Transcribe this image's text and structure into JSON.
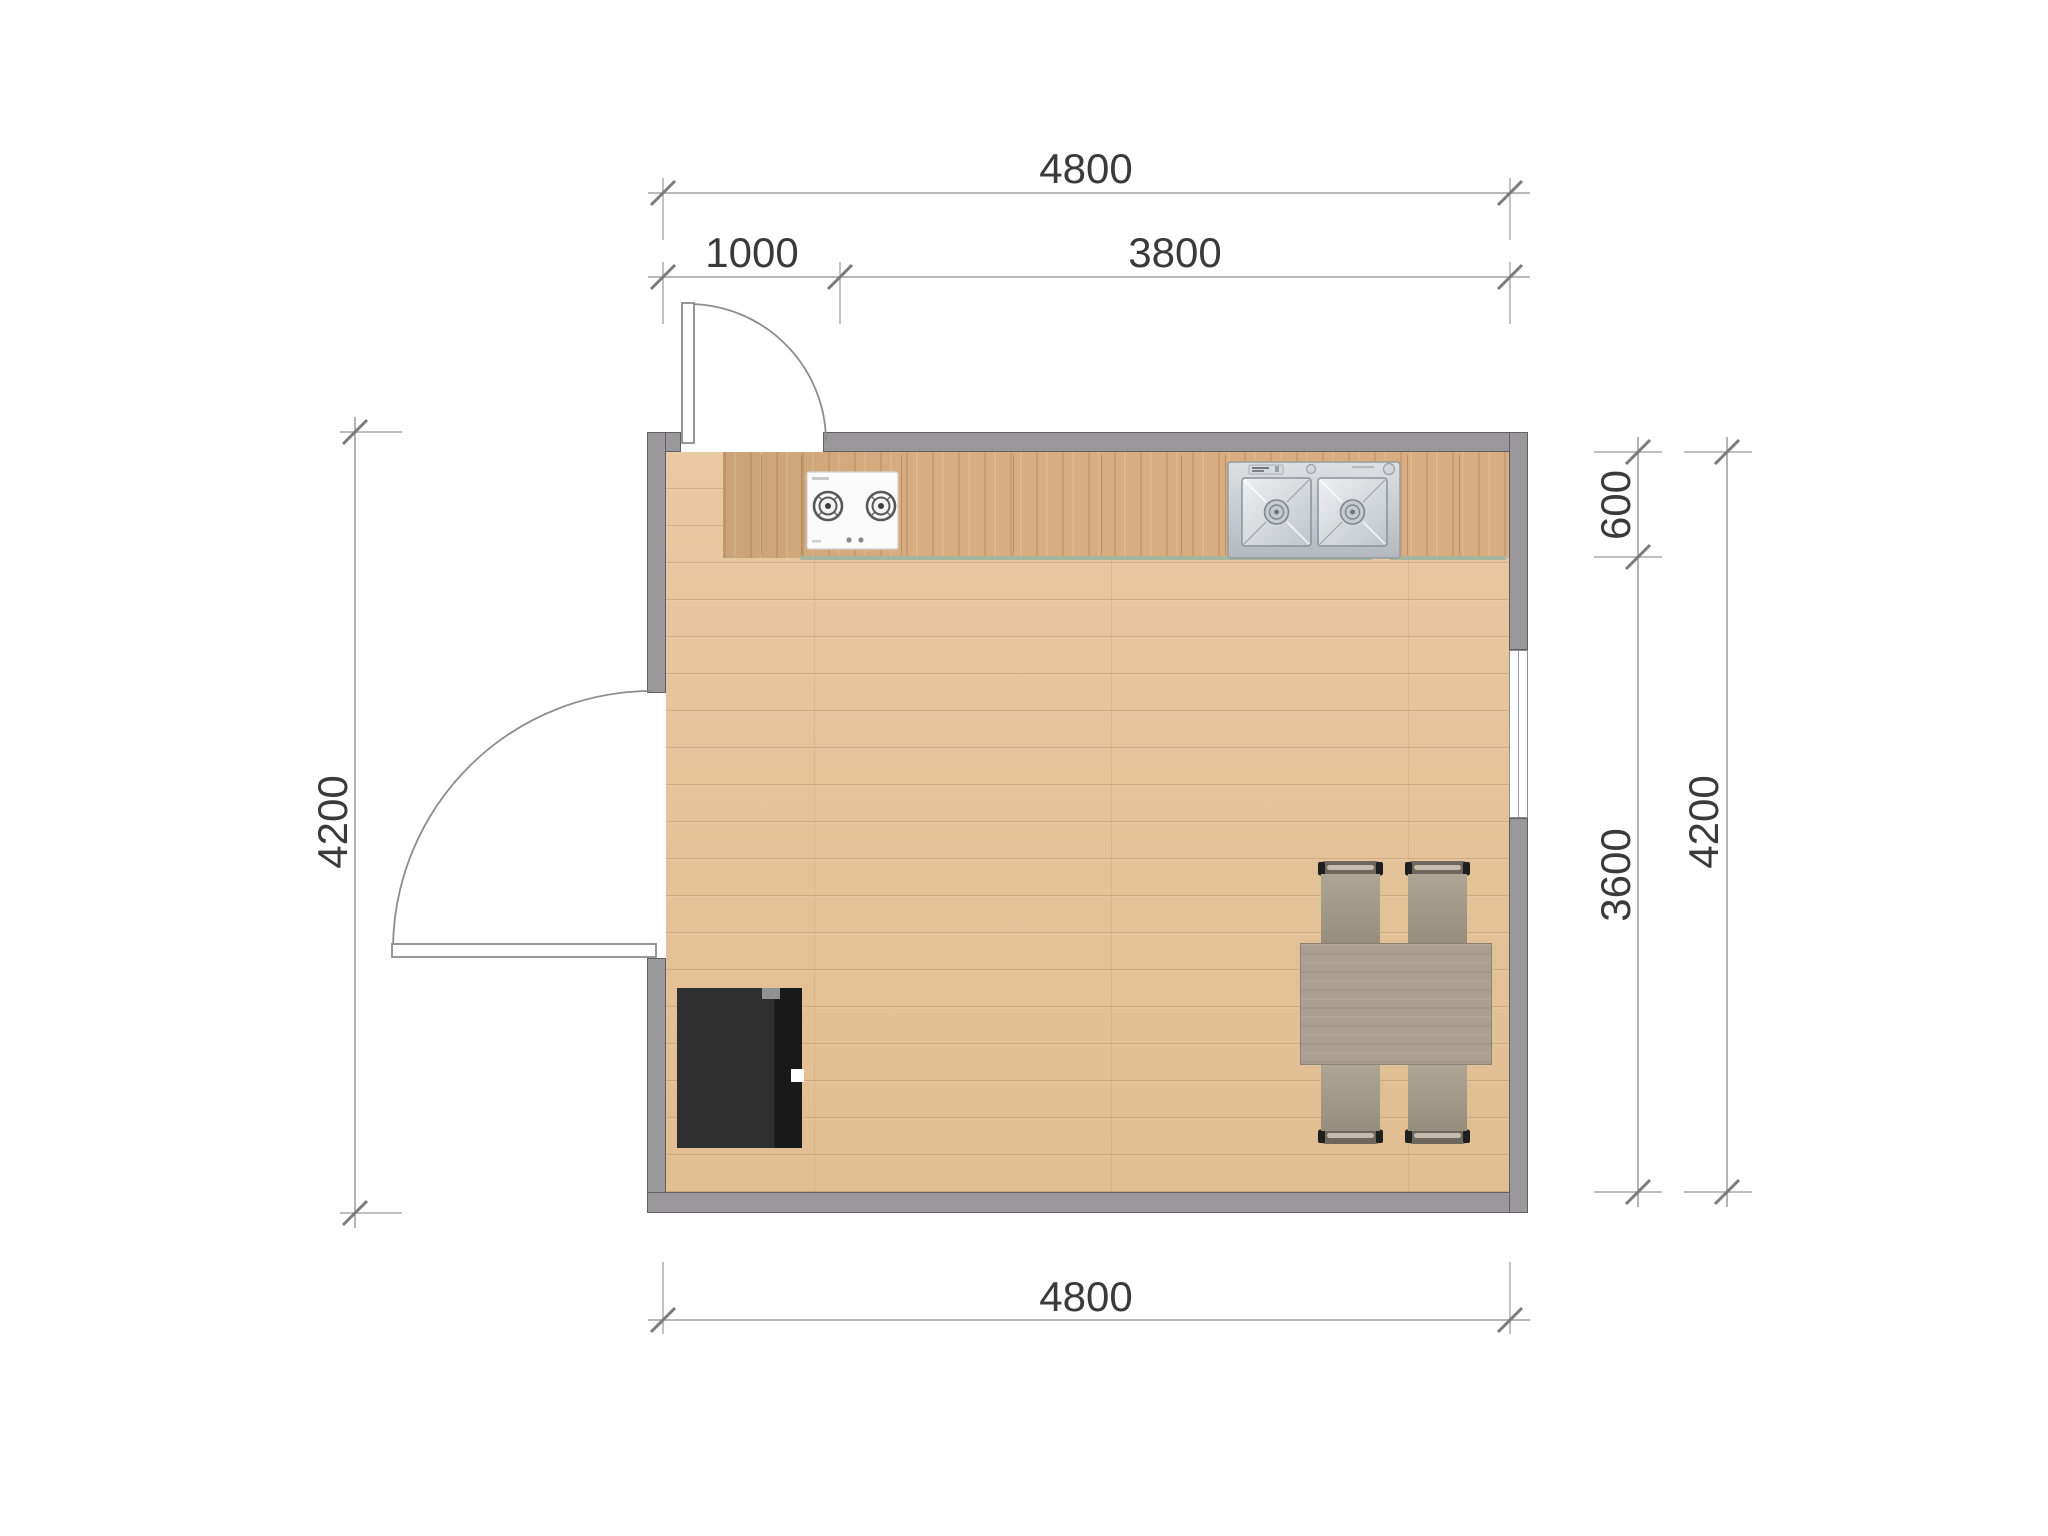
{
  "plan": {
    "type": "kitchen-floor-plan",
    "unit": "mm",
    "room": {
      "width_mm": 4800,
      "depth_mm": 4200
    },
    "dims": {
      "top_total": "4800",
      "top_segment_left": "1000",
      "top_segment_right": "3800",
      "left_total": "4200",
      "right_counter_depth": "600",
      "right_room_depth": "3600",
      "right_total": "4200",
      "bottom_total": "4800"
    },
    "objects": {
      "counter": "kitchen-counter",
      "cooktop": "gas-cooktop-2-burner",
      "sink": "double-bowl-sink",
      "dining_table": "dining-table",
      "chair_count": "4",
      "refrigerator": "refrigerator",
      "door_top": "swing-door",
      "door_left": "swing-door",
      "window_right": "window"
    },
    "colors": {
      "wall": "#9b989b",
      "wall_outline": "#615f62",
      "floor": "#e5c39a",
      "counter": "#d8ad80",
      "counter_edge": "#a6b59b",
      "table": "#a9a092",
      "chair": "#a39b8a",
      "refrigerator": "#2b2b2b",
      "sink_steel": "#c9ced3",
      "dimension_line": "#a2a2a2",
      "dimension_text": "#3a3a3a"
    }
  }
}
